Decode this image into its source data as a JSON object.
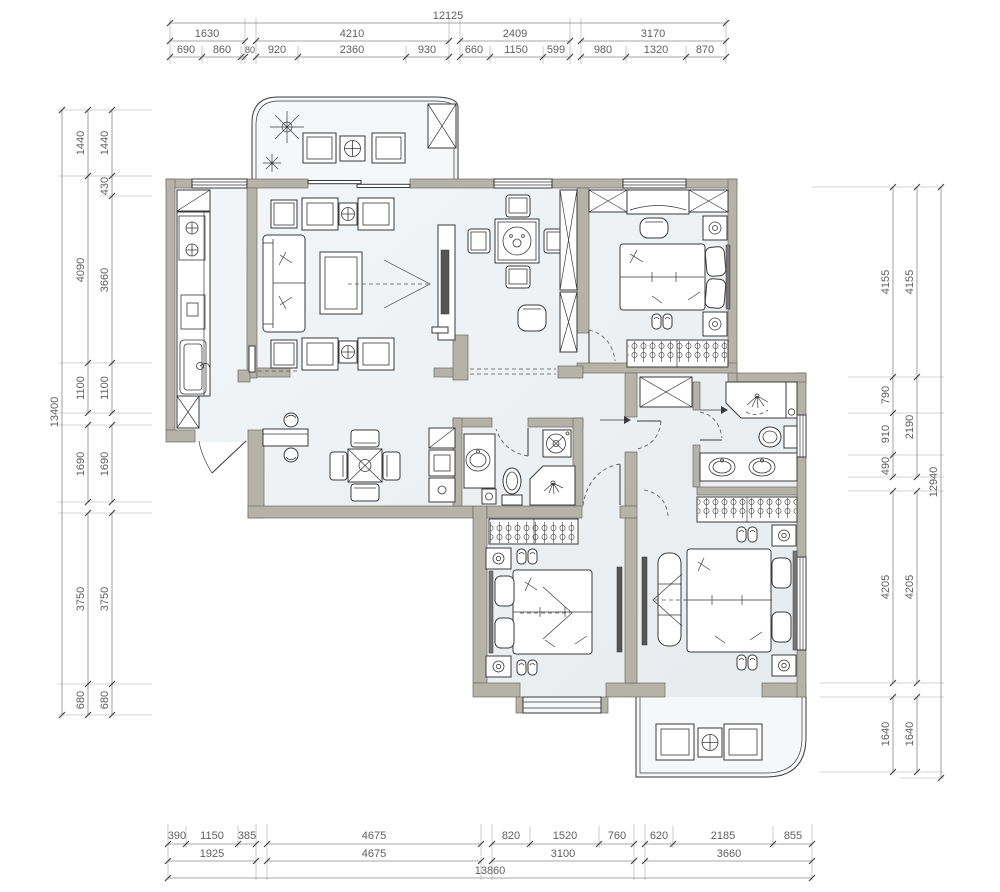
{
  "title": "apartment-floor-plan",
  "dims": {
    "top": {
      "total": "12125",
      "groups": [
        "1630",
        "4210",
        "2409",
        "3170"
      ],
      "segments": [
        "690",
        "860",
        "80",
        "920",
        "2360",
        "930",
        "660",
        "1150",
        "599",
        "980",
        "1320",
        "870"
      ]
    },
    "bottom": {
      "total": "13860",
      "groups": [
        "1925",
        "4675",
        "3100",
        "3660"
      ],
      "segments": [
        "390",
        "1150",
        "385",
        "4675",
        "820",
        "1520",
        "760",
        "620",
        "2185",
        "855"
      ]
    },
    "left": {
      "total": "13400",
      "groups": [
        "1440",
        "4090",
        "1100",
        "1690",
        "3750",
        "680"
      ],
      "segments": [
        "1440",
        "430",
        "3660",
        "1100",
        "1690",
        "3750",
        "680"
      ]
    },
    "right": {
      "total": "12940",
      "groups": [
        "4155",
        "2190",
        "4205",
        "1640"
      ],
      "segments": [
        "4155",
        "790",
        "910",
        "490",
        "4205",
        "1640"
      ]
    }
  },
  "colors": {
    "wall": "#b5b2a8",
    "wall_edge": "#6e6c65",
    "line": "#3a3a3a",
    "dim_line": "#8b8b8b",
    "dim_text": "#5f5f5f",
    "floor": "#eef1f4",
    "floor_light": "#f5f7f9"
  }
}
